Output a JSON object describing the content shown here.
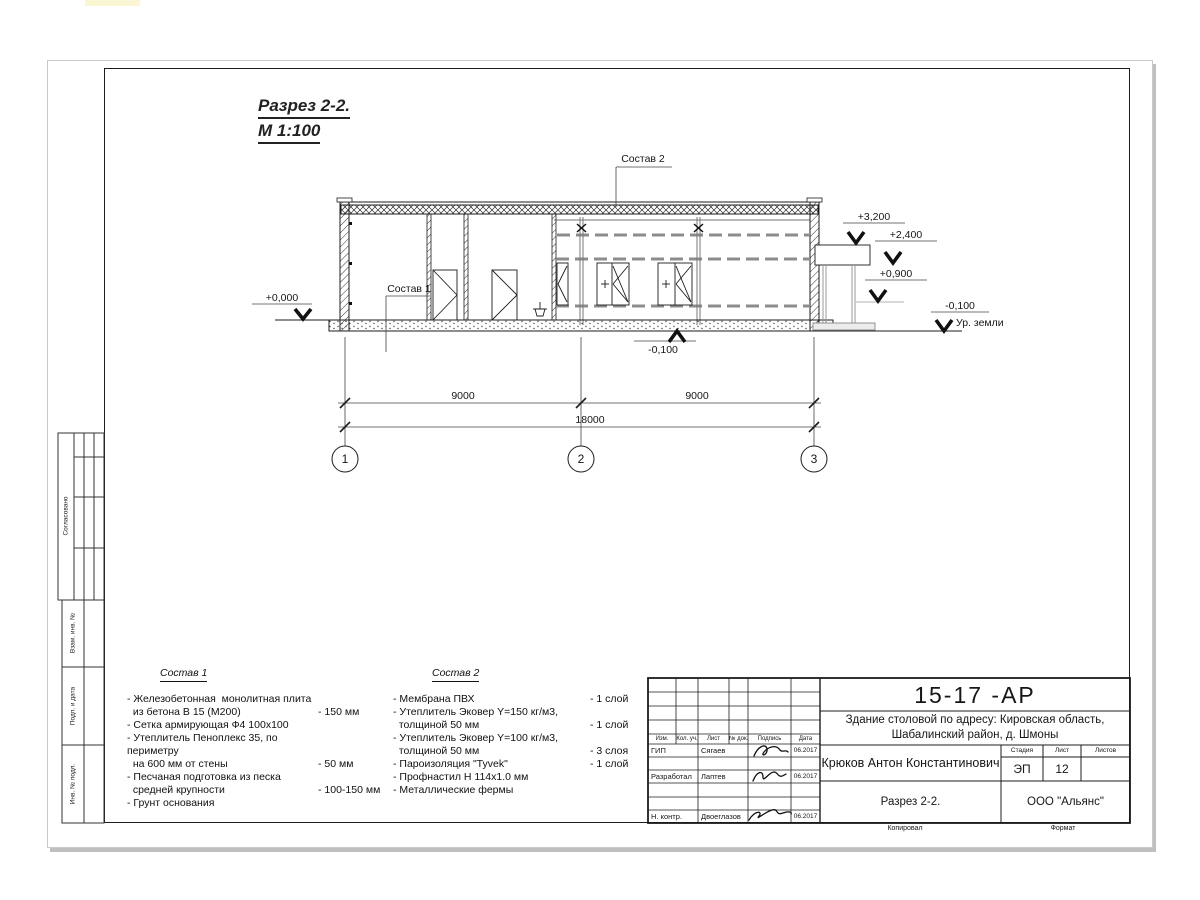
{
  "title": {
    "line1": "Разрез 2-2.",
    "line2": "М 1:100"
  },
  "section": {
    "labels": {
      "sostav1": "Состав 1",
      "sostav2": "Состав 2",
      "ground": "Ур. земли"
    },
    "elev": {
      "zero": "+0,000",
      "e3200": "+3,200",
      "e2400": "+2,400",
      "e0900": "+0,900",
      "em100r": "-0,100",
      "em100c": "-0,100"
    },
    "dims": {
      "d1": "9000",
      "d2": "9000",
      "dt": "18000"
    },
    "axes": {
      "a1": "1",
      "a2": "2",
      "a3": "3"
    }
  },
  "materials": {
    "sostav1": {
      "title": "Состав 1",
      "items": [
        {
          "name": "- Железобетонная  монолитная плита\n  из бетона В 15 (М200)",
          "value": "- 150 мм"
        },
        {
          "name": "- Сетка армирующая Ф4 100х100",
          "value": ""
        },
        {
          "name": "- Утеплитель Пеноплекс 35, по периметру\n  на 600 мм от стены",
          "value": "- 50 мм"
        },
        {
          "name": "- Песчаная подготовка из песка\n  средней крупности",
          "value": "- 100-150 мм"
        },
        {
          "name": "- Грунт основания",
          "value": ""
        }
      ]
    },
    "sostav2": {
      "title": "Состав 2",
      "items": [
        {
          "name": "- Мембрана ПВХ",
          "value": "- 1 слой"
        },
        {
          "name": "- Утеплитель Эковер Y=150 кг/м3,\n  толщиной 50 мм",
          "value": "- 1 слой"
        },
        {
          "name": "- Утеплитель Эковер Y=100 кг/м3,\n  толщиной 50 мм",
          "value": "- 3 слоя"
        },
        {
          "name": "- Пароизоляция \"Tyvek\"",
          "value": "- 1 слой"
        },
        {
          "name": "- Профнастил Н 114х1.0 мм",
          "value": ""
        },
        {
          "name": "- Металлические фермы",
          "value": ""
        }
      ]
    }
  },
  "margin_labels": {
    "approved": "Согласовано",
    "vzam": "Взам. инв. №",
    "podp": "Подп. и дата",
    "inv": "Инв. № подл."
  },
  "stamp": {
    "doc_number": "15-17 -АР",
    "project": "Здание столовой по адресу: Кировская область,\nШабалинский район, д. Шмоны",
    "cols": {
      "izm": "Изм.",
      "kol": "Кол. уч.",
      "list": "Лист",
      "doc": "№ док.",
      "sign": "Подпись",
      "date": "Дата"
    },
    "rows": [
      {
        "role": "ГИП",
        "name": "Сягаев",
        "date": "06.2017"
      },
      {
        "role": "Разработал",
        "name": "Лаптев",
        "date": "06.2017"
      },
      {
        "role": "Н. контр.",
        "name": "Двоеглазов",
        "date": "06.2017"
      }
    ],
    "chief": "Крюков Антон Константинович",
    "stage_label": "Стадия",
    "sheet_label": "Лист",
    "sheets_label": "Листов",
    "stage": "ЭП",
    "sheet": "12",
    "sheets": "",
    "sheet_title": "Разрез 2-2.",
    "company": "ООО \"Альянс\"",
    "copied": "Копировал",
    "format": "Формат"
  }
}
